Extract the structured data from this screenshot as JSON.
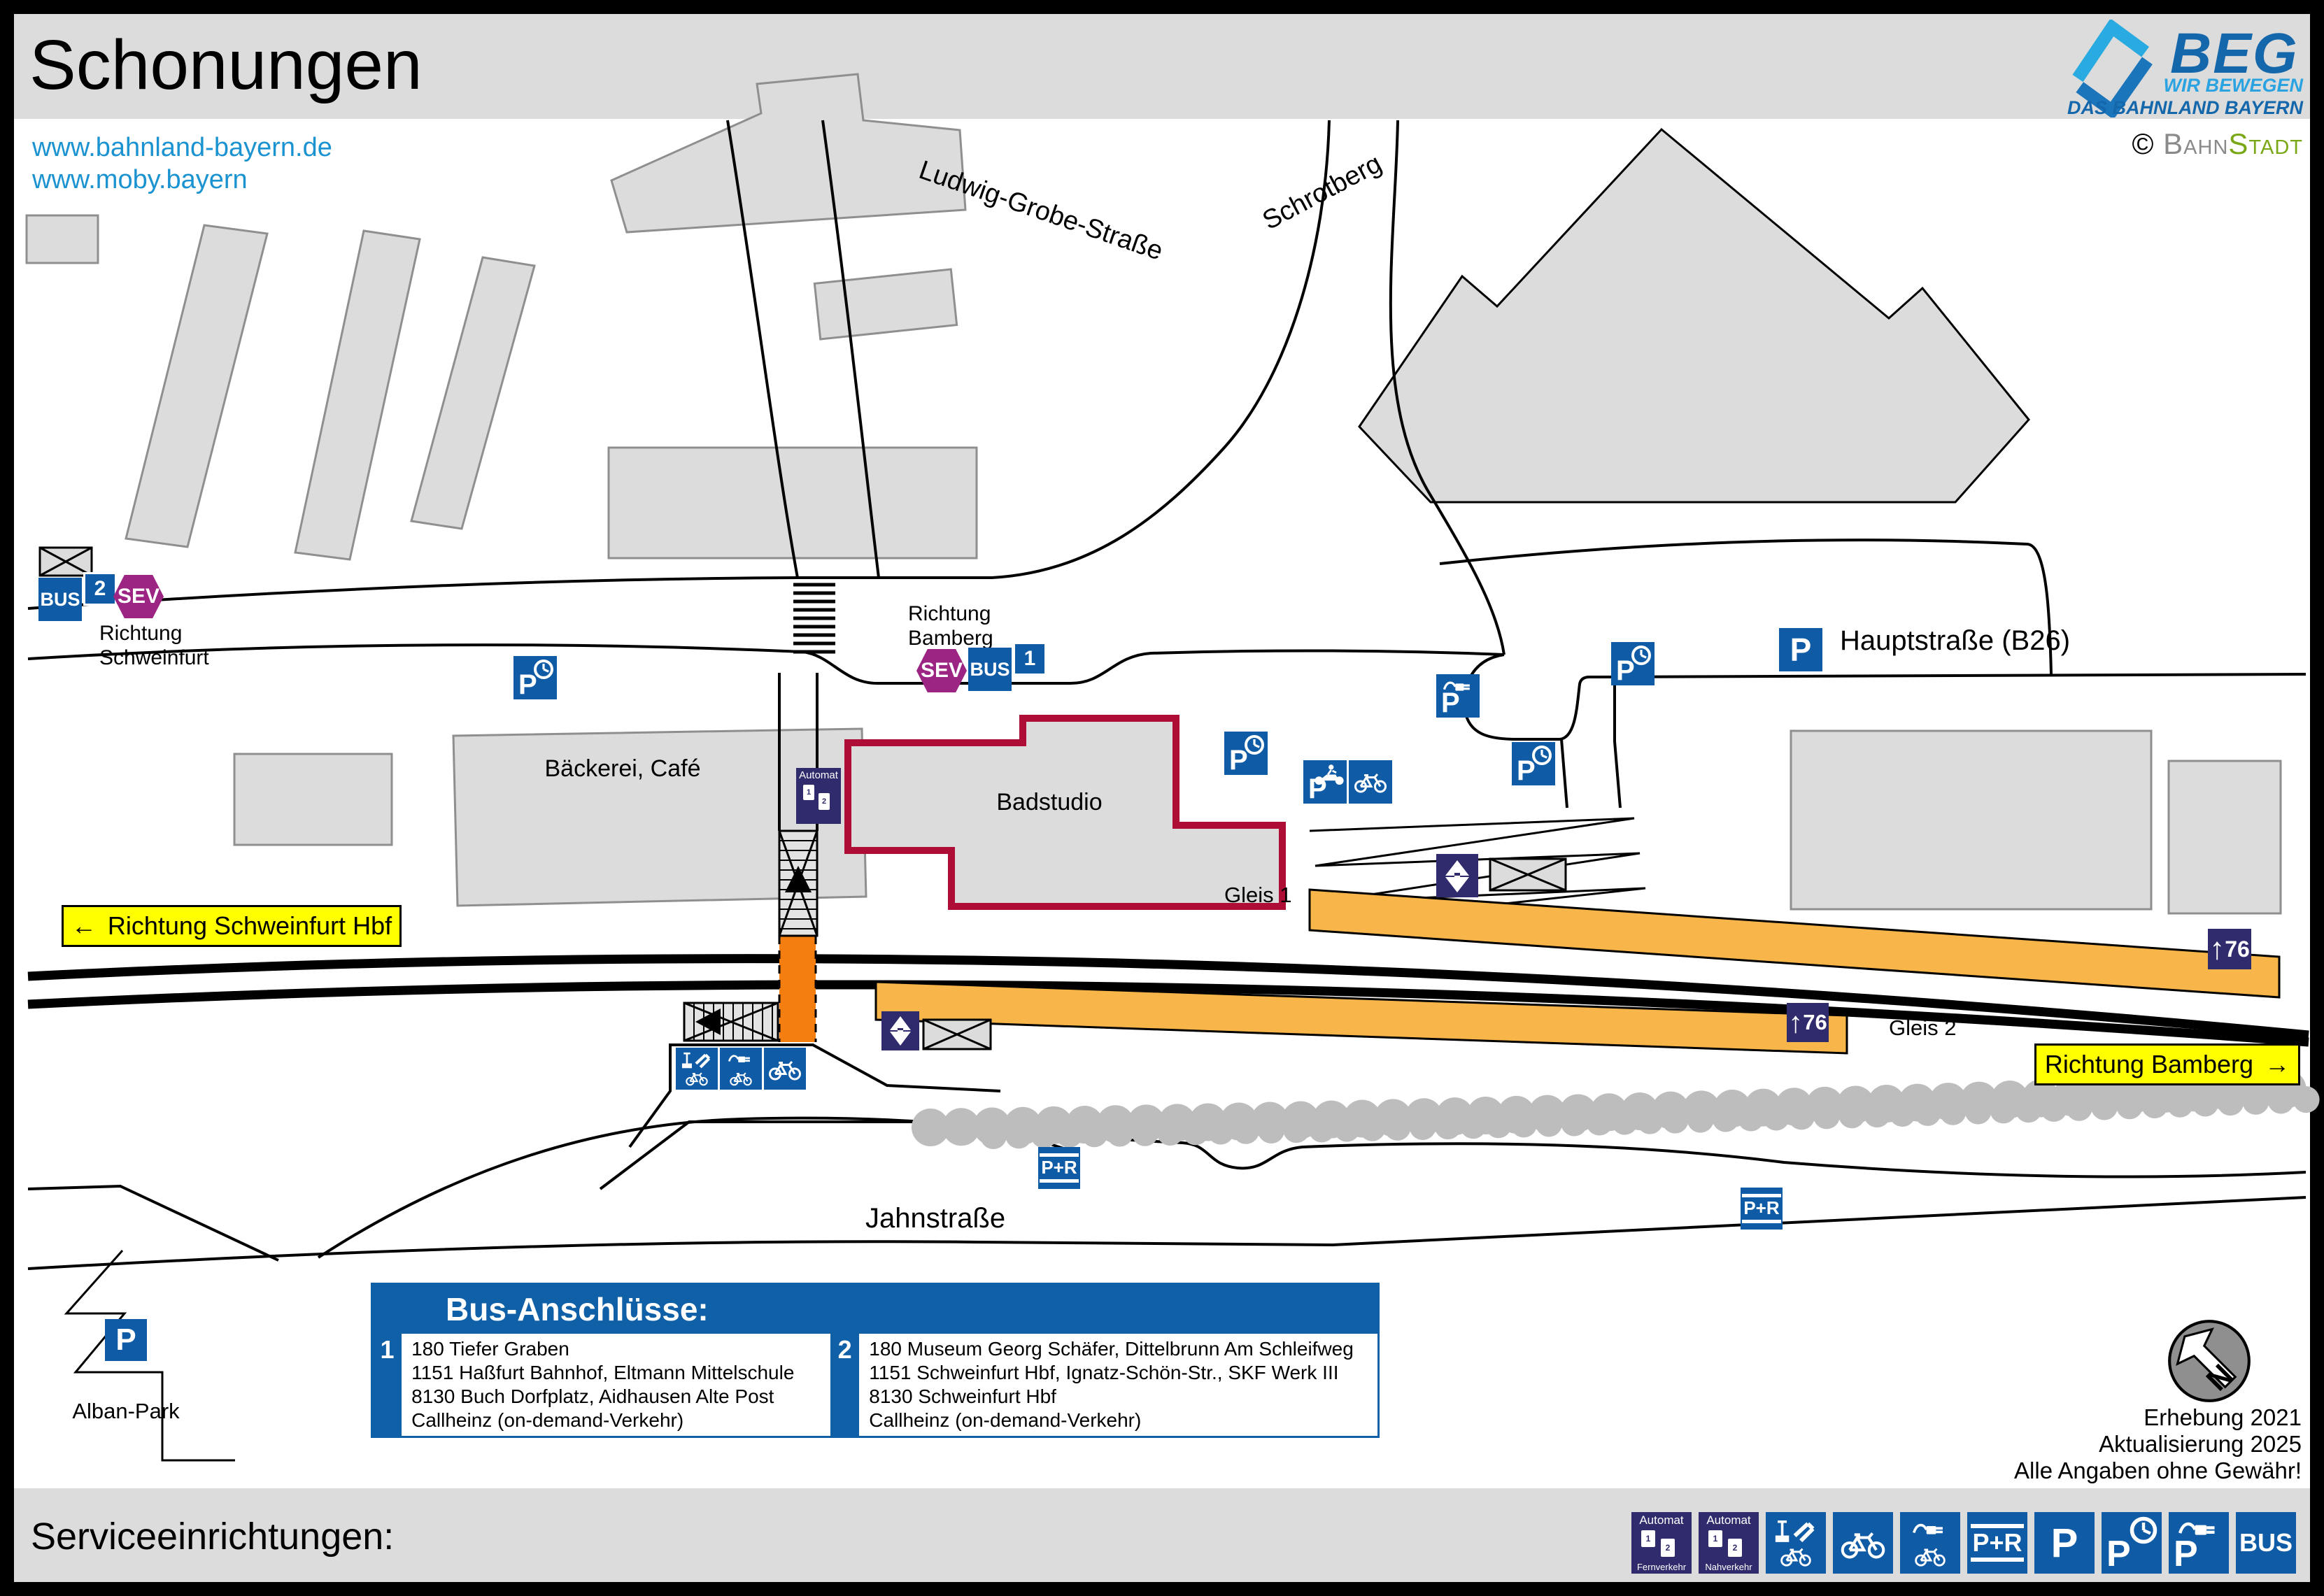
{
  "header": {
    "title": "Schonungen",
    "links": [
      "www.bahnland-bayern.de",
      "www.moby.bayern"
    ],
    "logo": {
      "name": "BEG",
      "tagline1": "WIR BEWEGEN",
      "tagline2": "DAS BAHNLAND BAYERN"
    },
    "credit": {
      "symbol": "©",
      "gray": "Bahn",
      "green": "Stadt"
    }
  },
  "map": {
    "streets": {
      "ludwig": "Ludwig-Grobe-Straße",
      "schrotberg": "Schrotberg",
      "haupt": "Hauptstraße (B26)",
      "jahn": "Jahnstraße"
    },
    "buildings": {
      "baeckerei": "Bäckerei, Café",
      "badstudio": "Badstudio"
    },
    "stops": {
      "west_lines": [
        "Richtung",
        "Schweinfurt"
      ],
      "east_lines": [
        "Richtung",
        "Bamberg"
      ]
    },
    "platforms": {
      "gleis1": "Gleis 1",
      "gleis2": "Gleis 2",
      "length": "76"
    },
    "directions": {
      "west": {
        "arrow": "←",
        "text": "Richtung Schweinfurt Hbf"
      },
      "east": {
        "text": "Richtung Bamberg",
        "arrow": "→"
      }
    },
    "park": {
      "label": "Alban-Park"
    },
    "north": "N",
    "notes": [
      "Erhebung 2021",
      "Aktualisierung 2025",
      "Alle Angaben ohne Gewähr!"
    ]
  },
  "icons": {
    "p": "P",
    "bus": "BUS",
    "sev": "SEV",
    "pr": "P+R",
    "automat": "Automat",
    "fern": "Fernverkehr",
    "nah": "Nahverkehr",
    "one": "1",
    "two": "2",
    "arrow_up": "↑"
  },
  "bus_box": {
    "title": "Bus-Anschlüsse:",
    "groups": [
      {
        "number": "1",
        "lines": [
          "180 Tiefer Graben",
          "1151 Haßfurt Bahnhof, Eltmann Mittelschule",
          "8130 Buch Dorfplatz, Aidhausen Alte Post",
          "Callheinz (on-demand-Verkehr)"
        ]
      },
      {
        "number": "2",
        "lines": [
          "180 Museum Georg Schäfer, Dittelbrunn Am Schleifweg",
          "1151 Schweinfurt Hbf, Ignatz-Schön-Str., SKF Werk III",
          "8130 Schweinfurt Hbf",
          "Callheinz (on-demand-Verkehr)"
        ]
      }
    ]
  },
  "footer": {
    "title": "Serviceeinrichtungen:"
  },
  "colors": {
    "icon_blue": "#0f5ba6",
    "navy": "#2f2b6d",
    "sev_purple": "#9c2482",
    "platform_orange": "#f7b54a",
    "crossing_orange": "#f57e10",
    "highlight_yellow": "#ffff00",
    "badstudio_red": "#ae0e35",
    "link_blue": "#1b93d1",
    "building_gray": "#dcdcdc"
  }
}
